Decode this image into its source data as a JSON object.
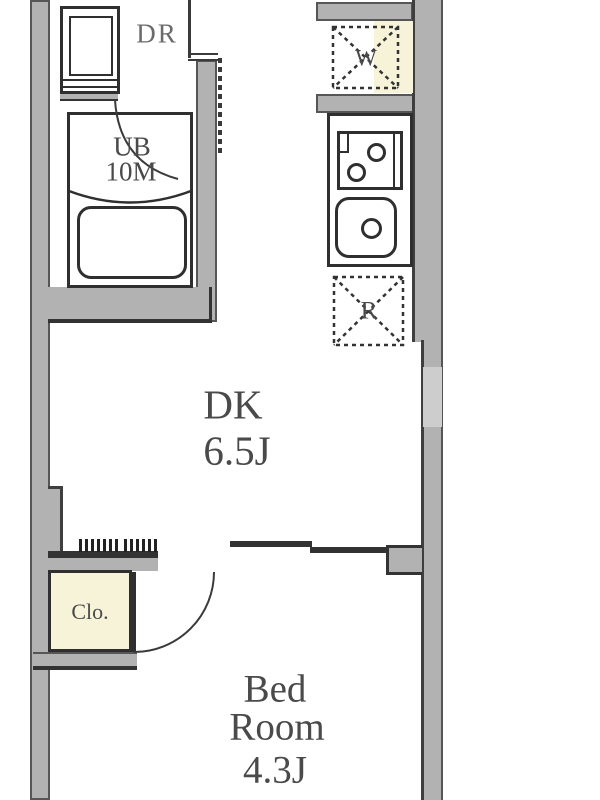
{
  "floorplan": {
    "rooms": {
      "dressing": {
        "label": "DR"
      },
      "unit_bath": {
        "label": "UB",
        "size": "10M"
      },
      "dining_kitchen": {
        "label": "DK",
        "size": "6.5J"
      },
      "bedroom": {
        "label_line1": "Bed",
        "label_line2": "Room",
        "size": "4.3J"
      },
      "closet": {
        "label": "Clo."
      }
    },
    "fixtures": {
      "washing_machine": {
        "label": "W"
      },
      "refrigerator": {
        "label": "R"
      }
    },
    "colors": {
      "wall_fill": "#b2b2b2",
      "wall_light_patch": "#cdcdcd",
      "outline": "#2f2f2f",
      "accent_cream": "#f6f3d8",
      "label_text": "#4a4a4a"
    }
  }
}
